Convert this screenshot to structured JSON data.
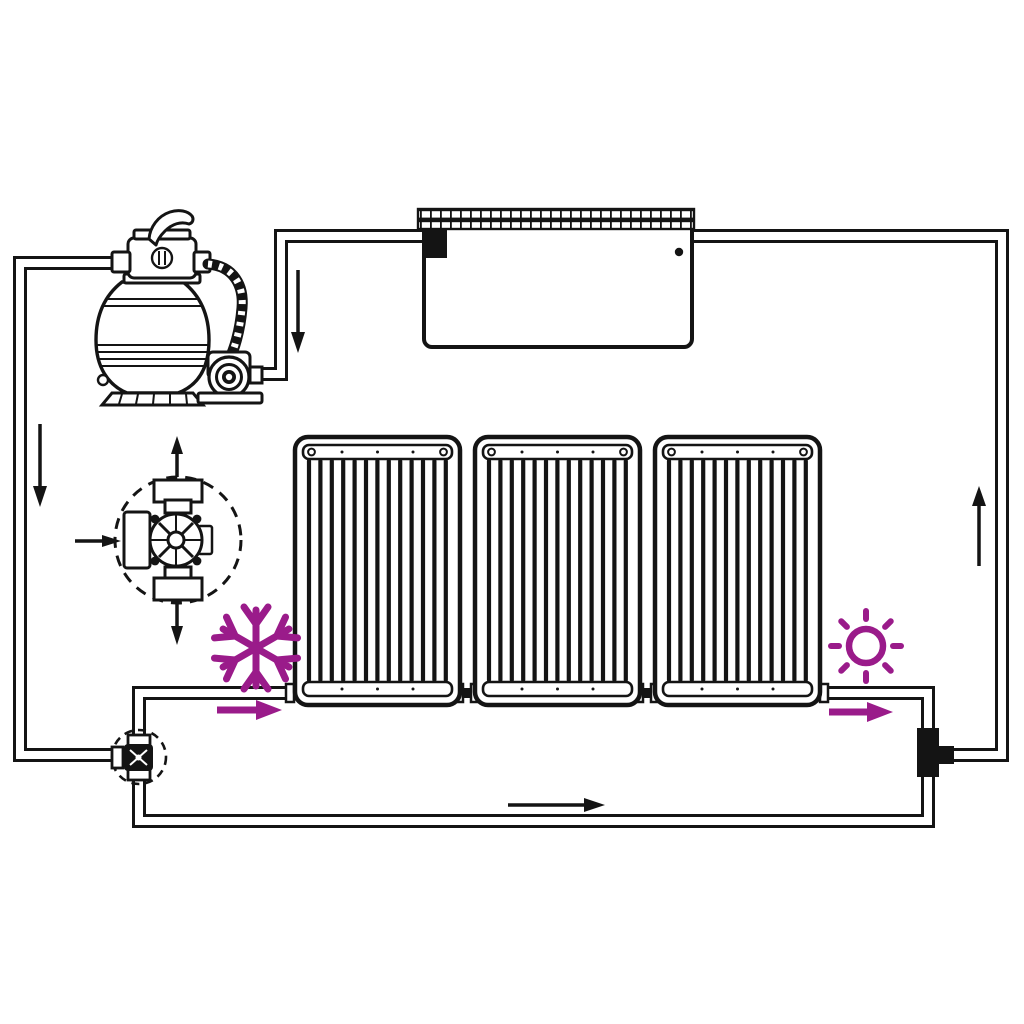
{
  "diagram": {
    "kind": "installation-schematic",
    "subject": "solar-pool-heater-water-circuit",
    "text_labels": []
  },
  "colors": {
    "background": "#ffffff",
    "line": "#141414",
    "accent": "#9a1b8a"
  },
  "components": {
    "pool": {
      "name": "pool-basin",
      "features": [
        "tiled-coping-band",
        "skimmer-inlet-black-square",
        "return-dot"
      ]
    },
    "sand_filter_pump": {
      "name": "sand-filter-pump",
      "features": [
        "multiport-valve-head",
        "lever-handle",
        "filter-tank",
        "ribbed-hose",
        "pump-motor-volute",
        "base"
      ]
    },
    "solar_panels": {
      "name": "solar-collector-panel",
      "count": 3,
      "tubes_per_panel": 13,
      "connection": "bottom-manifold-couplings"
    },
    "diverter_valve_detail": {
      "name": "three-way-diverter-valve-detail",
      "enclosure": "dashed-circle",
      "ports": [
        "in-left",
        "out-top",
        "out-bottom"
      ]
    },
    "bypass_valve": {
      "name": "bypass-three-way-valve",
      "enclosure": "dashed-circle"
    },
    "tee_fitting": {
      "name": "return-tee-fitting"
    }
  },
  "icons": {
    "snowflake": {
      "name": "snowflake-icon",
      "meaning": "cold-water-side",
      "color": "#9a1b8a"
    },
    "sun": {
      "name": "sun-icon",
      "meaning": "heated-water-side",
      "color": "#9a1b8a"
    }
  },
  "flow_arrows": {
    "black": [
      {
        "name": "arrow-down-pool-to-pump",
        "direction": "down"
      },
      {
        "name": "arrow-down-main-left-riser",
        "direction": "down"
      },
      {
        "name": "arrow-up-return-riser",
        "direction": "up"
      },
      {
        "name": "arrow-right-bottom-bypass",
        "direction": "right"
      },
      {
        "name": "arrow-into-valve-detail",
        "direction": "right"
      },
      {
        "name": "arrow-out-valve-detail-top",
        "direction": "up"
      },
      {
        "name": "arrow-out-valve-detail-bottom",
        "direction": "down"
      }
    ],
    "purple": [
      {
        "name": "arrow-cold-into-panels",
        "direction": "right"
      },
      {
        "name": "arrow-hot-out-of-panels",
        "direction": "right"
      }
    ]
  }
}
